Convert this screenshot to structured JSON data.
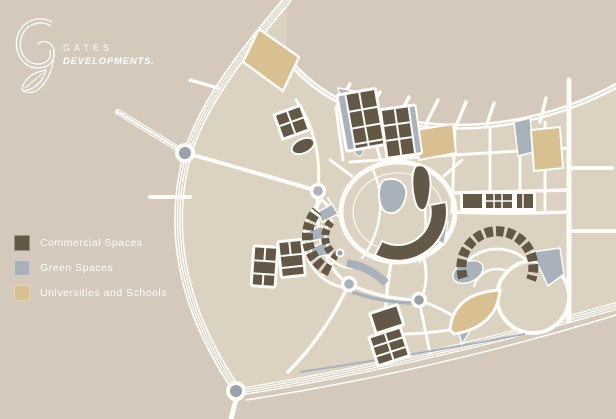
{
  "logo": {
    "brand_top": "GATES",
    "brand_bottom": "DEVELOPMENTS."
  },
  "legend": {
    "items": [
      {
        "key": "commercial",
        "label": "Commercial Spaces",
        "color": "#635848"
      },
      {
        "key": "green",
        "label": "Green Spaces",
        "color": "#a9b2bb"
      },
      {
        "key": "university",
        "label": "Universities and Schools",
        "color": "#d9c092"
      }
    ]
  },
  "map": {
    "type": "masterplan-illustration",
    "features": [
      "curved boulevard on north-west edge",
      "diagonal highway on south edge with two roundabouts",
      "central ring district with lake, commercial crescent and commercial block",
      "two commercial grid clusters at top center",
      "commercial strip row east of center",
      "commercial arc necklace and circular park at south-east",
      "university parcels at north-west, north-east and south-east"
    ]
  },
  "colors": {
    "background": "#d4c9ba",
    "district": "#dcd2c2",
    "road": "#fdfcf8",
    "commercial": "#635848",
    "green": "#a9b2bb",
    "university": "#d9c092",
    "roundabout": "#99a2ab"
  }
}
